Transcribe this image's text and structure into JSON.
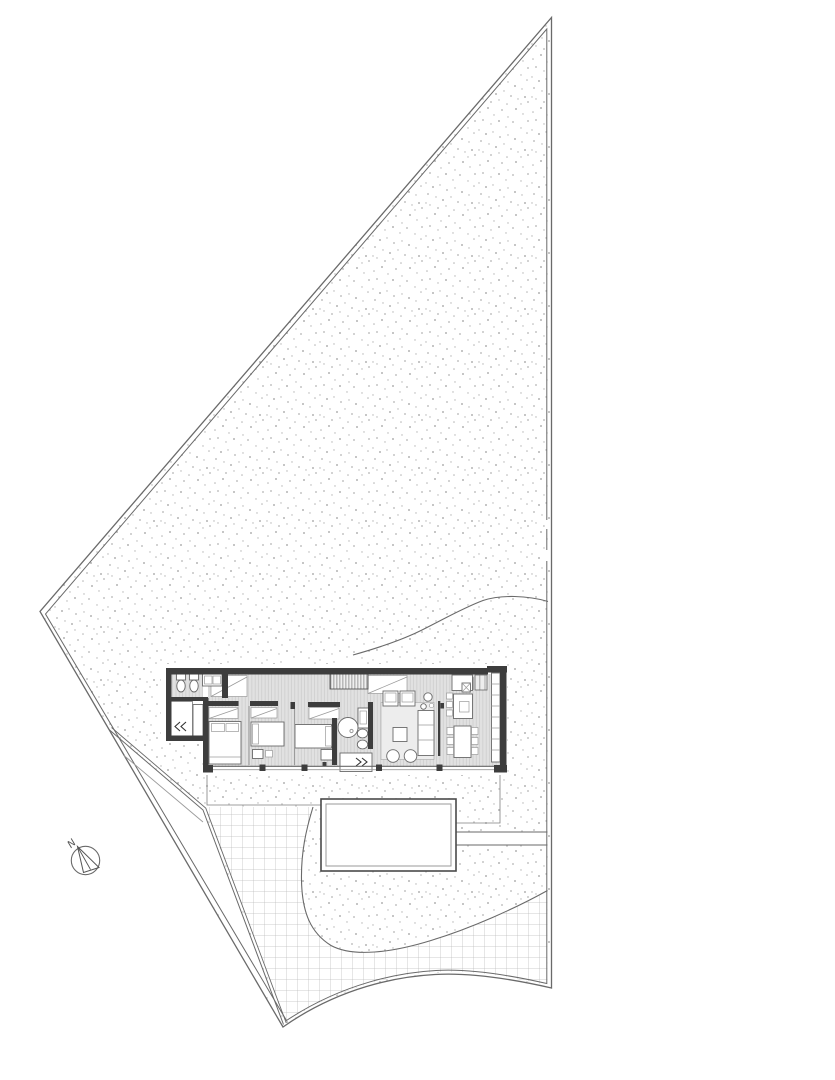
{
  "drawing": {
    "north_label": "N"
  },
  "palette": {
    "paper": "#ffffff",
    "walls": "#3d3d3d",
    "lines": "#6a6a6a",
    "lightline": "#9b9b9b",
    "floor": "#e1e1e1",
    "floorline": "#c8c8c8",
    "stipple": "#b3b3b3",
    "grid": "#bdbdbd",
    "rug": "#ededed"
  }
}
